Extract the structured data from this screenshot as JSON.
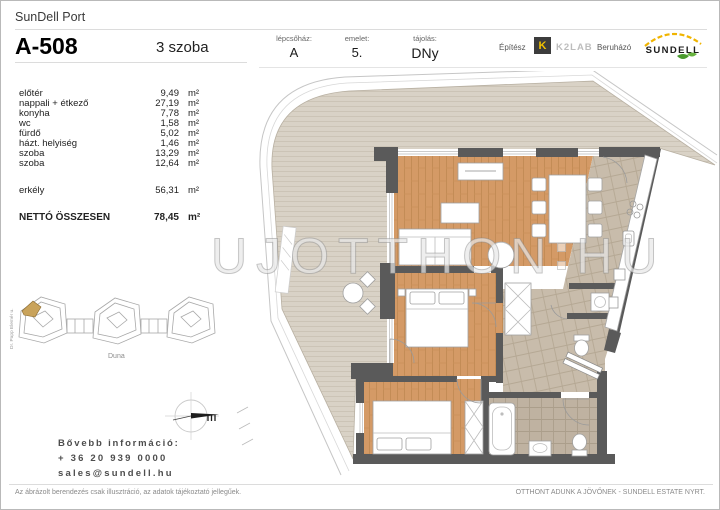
{
  "header": {
    "project": "SunDell Port",
    "unit_id": "A-508",
    "unit_type": "3 szoba",
    "staircase_label": "lépcsőház:",
    "staircase_value": "A",
    "floor_label": "emelet:",
    "floor_value": "5.",
    "orientation_label": "tájolás:",
    "orientation_value": "DNy",
    "architect_label": "Építész",
    "developer_label": "Beruházó"
  },
  "logos": {
    "architect_mark": "K",
    "architect_name": "K2LAB",
    "developer_name": "SUNDELL"
  },
  "areas": {
    "rows": [
      {
        "name": "előtér",
        "value": "9,49",
        "unit": "m²"
      },
      {
        "name": "nappali + étkező",
        "value": "27,19",
        "unit": "m²"
      },
      {
        "name": "konyha",
        "value": "7,78",
        "unit": "m²"
      },
      {
        "name": "wc",
        "value": "1,58",
        "unit": "m²"
      },
      {
        "name": "fürdő",
        "value": "5,02",
        "unit": "m²"
      },
      {
        "name": "házt. helyiség",
        "value": "1,46",
        "unit": "m²"
      },
      {
        "name": "szoba",
        "value": "13,29",
        "unit": "m²"
      },
      {
        "name": "szoba",
        "value": "12,64",
        "unit": "m²"
      }
    ],
    "balcony": {
      "name": "erkély",
      "value": "56,31",
      "unit": "m²"
    },
    "total": {
      "name": "NETTÓ ÖSSZESEN",
      "value": "78,45",
      "unit": "m²"
    }
  },
  "siteplan": {
    "street": "Dr. Papp Elemér u.",
    "river": "Duna"
  },
  "contact": {
    "title": "Bővebb információ:",
    "phone": "+ 36 20 939 0000",
    "email": "sales@sundell.hu"
  },
  "watermark": {
    "part1": "UJOTTHON",
    "part2": "HU"
  },
  "footer": {
    "disclaimer": "Az ábrázolt berendezés csak illusztráció, az adatok tájékoztató jellegűek.",
    "slogan": "OTTHONT ADUNK A JÖVŐNEK - SUNDELL ESTATE NYRT."
  },
  "colors": {
    "wood_floor": "#d49a66",
    "deck_floor": "#d9d2c6",
    "tile_floor": "#c8bcab",
    "bath_tile": "#bfb2a1",
    "wall": "#5a5a5a",
    "site_highlight": "#c9a35b",
    "k2lab_yellow": "#f2c200",
    "k2lab_box": "#3c3c3c",
    "sundell_yellow": "#f0b400",
    "sundell_green": "#4a9a2e"
  }
}
